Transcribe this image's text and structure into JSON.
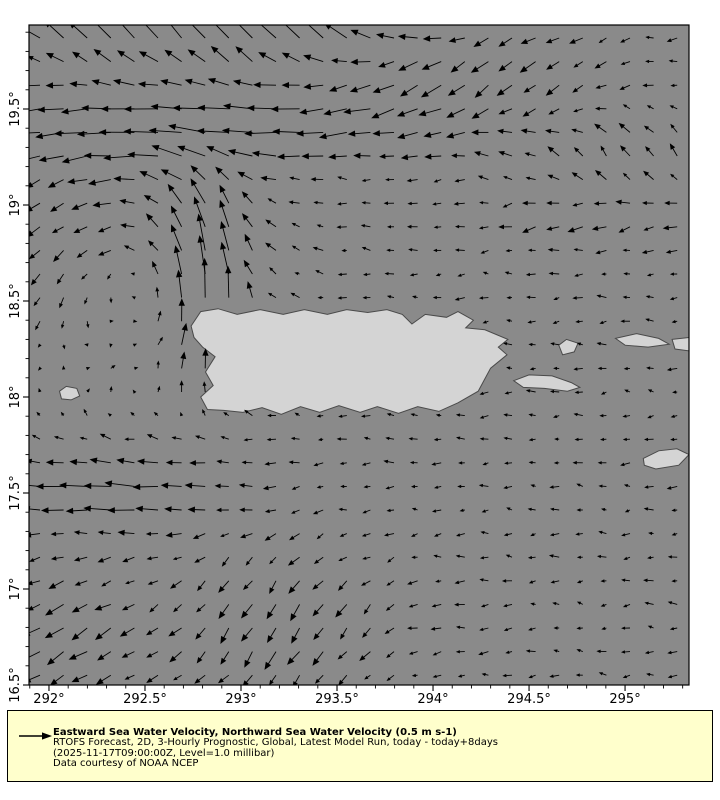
{
  "window": {
    "width": 720,
    "height": 800,
    "background": "#ffffff"
  },
  "map": {
    "plot_left": 29,
    "plot_top": 25,
    "plot_width": 660,
    "plot_height": 660,
    "lon_min": 291.896,
    "lon_max": 295.333,
    "lat_min": 16.5,
    "lat_max": 19.9375,
    "ocean_color": "#8a8a8a",
    "land_color": "#d4d4d4",
    "coast_color": "#4a4a4a",
    "arrow_color": "#000000",
    "frame_color": "#000000",
    "tick_label_color": "#000000"
  },
  "axes": {
    "font_size": 13,
    "minor_step": 0.1,
    "x_ticks": [
      {
        "lon": 292.0,
        "label": "292°"
      },
      {
        "lon": 292.5,
        "label": "292.5°"
      },
      {
        "lon": 293.0,
        "label": "293°"
      },
      {
        "lon": 293.5,
        "label": "293.5°"
      },
      {
        "lon": 294.0,
        "label": "294°"
      },
      {
        "lon": 294.5,
        "label": "294.5°"
      },
      {
        "lon": 295.0,
        "label": "295°"
      }
    ],
    "y_ticks": [
      {
        "lat": 16.5,
        "label": "16.5°"
      },
      {
        "lat": 17.0,
        "label": "17°"
      },
      {
        "lat": 17.5,
        "label": "17.5°"
      },
      {
        "lat": 18.0,
        "label": "18°"
      },
      {
        "lat": 18.5,
        "label": "18.5°"
      },
      {
        "lat": 19.0,
        "label": "19°"
      },
      {
        "lat": 19.5,
        "label": "19.5°"
      }
    ]
  },
  "islands": [
    {
      "name": "puerto-rico",
      "points": [
        [
          292.74,
          18.37
        ],
        [
          292.79,
          18.445
        ],
        [
          292.88,
          18.46
        ],
        [
          292.98,
          18.43
        ],
        [
          293.1,
          18.455
        ],
        [
          293.22,
          18.43
        ],
        [
          293.33,
          18.455
        ],
        [
          293.45,
          18.43
        ],
        [
          293.55,
          18.455
        ],
        [
          293.66,
          18.44
        ],
        [
          293.76,
          18.455
        ],
        [
          293.84,
          18.43
        ],
        [
          293.89,
          18.38
        ],
        [
          293.96,
          18.43
        ],
        [
          294.07,
          18.415
        ],
        [
          294.13,
          18.445
        ],
        [
          294.21,
          18.4
        ],
        [
          294.17,
          18.36
        ],
        [
          294.27,
          18.35
        ],
        [
          294.39,
          18.3
        ],
        [
          294.34,
          18.26
        ],
        [
          294.385,
          18.22
        ],
        [
          294.3,
          18.15
        ],
        [
          294.235,
          18.03
        ],
        [
          294.13,
          17.97
        ],
        [
          294.03,
          17.925
        ],
        [
          293.92,
          17.95
        ],
        [
          293.82,
          17.915
        ],
        [
          293.71,
          17.95
        ],
        [
          293.62,
          17.92
        ],
        [
          293.51,
          17.955
        ],
        [
          293.41,
          17.92
        ],
        [
          293.31,
          17.95
        ],
        [
          293.21,
          17.91
        ],
        [
          293.11,
          17.945
        ],
        [
          293.01,
          17.92
        ],
        [
          292.91,
          17.93
        ],
        [
          292.825,
          17.935
        ],
        [
          292.79,
          18.0
        ],
        [
          292.855,
          18.06
        ],
        [
          292.815,
          18.13
        ],
        [
          292.865,
          18.21
        ],
        [
          292.8,
          18.26
        ],
        [
          292.755,
          18.31
        ]
      ]
    },
    {
      "name": "mona-island",
      "points": [
        [
          292.055,
          18.03
        ],
        [
          292.09,
          18.055
        ],
        [
          292.145,
          18.045
        ],
        [
          292.16,
          18.005
        ],
        [
          292.115,
          17.985
        ],
        [
          292.065,
          17.99
        ]
      ]
    },
    {
      "name": "vieques-island",
      "points": [
        [
          294.42,
          18.085
        ],
        [
          294.5,
          18.115
        ],
        [
          294.62,
          18.11
        ],
        [
          294.72,
          18.075
        ],
        [
          294.765,
          18.05
        ],
        [
          294.7,
          18.03
        ],
        [
          294.58,
          18.045
        ],
        [
          294.47,
          18.05
        ]
      ]
    },
    {
      "name": "culebra-island",
      "points": [
        [
          294.655,
          18.27
        ],
        [
          294.695,
          18.3
        ],
        [
          294.755,
          18.28
        ],
        [
          294.735,
          18.235
        ],
        [
          294.675,
          18.22
        ]
      ]
    },
    {
      "name": "st-thomas-island",
      "points": [
        [
          294.95,
          18.305
        ],
        [
          295.06,
          18.33
        ],
        [
          295.175,
          18.305
        ],
        [
          295.23,
          18.275
        ],
        [
          295.12,
          18.26
        ],
        [
          295.0,
          18.27
        ]
      ]
    },
    {
      "name": "tortola-island",
      "points": [
        [
          295.245,
          18.3
        ],
        [
          295.333,
          18.31
        ],
        [
          295.333,
          18.24
        ],
        [
          295.26,
          18.25
        ]
      ]
    },
    {
      "name": "st-croix-island",
      "points": [
        [
          295.095,
          17.68
        ],
        [
          295.175,
          17.72
        ],
        [
          295.27,
          17.73
        ],
        [
          295.333,
          17.7
        ],
        [
          295.28,
          17.645
        ],
        [
          295.16,
          17.625
        ],
        [
          295.1,
          17.645
        ]
      ]
    }
  ],
  "chart_data": {
    "type": "quiver",
    "title": "Eastward Sea Water Velocity, Northward Sea Water Velocity (0.5 m s-1)",
    "xlabel": "",
    "ylabel": "",
    "x_range": [
      291.896,
      295.333
    ],
    "y_range": [
      16.5,
      19.9375
    ],
    "x_tick_labels": [
      "292°",
      "292.5°",
      "293°",
      "293.5°",
      "294°",
      "294.5°",
      "295°"
    ],
    "y_tick_labels": [
      "16.5°",
      "17°",
      "17.5°",
      "18°",
      "18.5°",
      "19°",
      "19.5°"
    ],
    "reference_speed_ms": 0.5,
    "scale_px_per_ms": 56,
    "grid": {
      "x0": 40,
      "y0": 38,
      "dx": 23.6,
      "dy": 23.6,
      "nx": 28,
      "ny": 28
    },
    "noise_amp": 0.05,
    "field_features_estimated": [
      {
        "type": "uniform",
        "u": -0.14,
        "v": 0
      },
      {
        "type": "gauss",
        "lon": 292.9,
        "lat": 19.95,
        "sx": 1.1,
        "sy": 0.22,
        "u": -0.35,
        "v": 0.6
      },
      {
        "type": "gauss",
        "lon": 292.9,
        "lat": 19.42,
        "sx": 1.3,
        "sy": 0.22,
        "u": -0.42,
        "v": -0.02
      },
      {
        "type": "gauss",
        "lon": 292.82,
        "lat": 18.6,
        "sx": 0.22,
        "sy": 0.55,
        "u": 0.06,
        "v": 0.52
      },
      {
        "type": "vortex",
        "lon": 292.42,
        "lat": 18.68,
        "radius": 0.6,
        "strength": 0.42
      },
      {
        "type": "gauss",
        "lon": 292.35,
        "lat": 17.52,
        "sx": 0.6,
        "sy": 0.22,
        "u": -0.4,
        "v": 0.02
      },
      {
        "type": "gauss",
        "lon": 293.2,
        "lat": 16.8,
        "sx": 0.55,
        "sy": 0.45,
        "u": -0.04,
        "v": -0.3
      },
      {
        "type": "gauss",
        "lon": 292.1,
        "lat": 16.75,
        "sx": 0.45,
        "sy": 0.35,
        "u": -0.18,
        "v": -0.2
      },
      {
        "type": "gauss",
        "lon": 294.2,
        "lat": 19.75,
        "sx": 0.7,
        "sy": 0.35,
        "u": -0.1,
        "v": -0.28
      },
      {
        "type": "gauss",
        "lon": 295.05,
        "lat": 19.25,
        "sx": 0.7,
        "sy": 0.25,
        "u": 0.02,
        "v": 0.22
      },
      {
        "type": "gauss",
        "lon": 294.9,
        "lat": 18.95,
        "sx": 0.7,
        "sy": 0.15,
        "u": -0.12,
        "v": -0.12
      },
      {
        "type": "gauss",
        "lon": 292.15,
        "lat": 18.0,
        "sx": 0.3,
        "sy": 0.25,
        "u": 0.03,
        "v": 0.16
      }
    ]
  },
  "legend": {
    "bg": "#ffffcc",
    "border_color": "#000000",
    "title": "Eastward Sea Water Velocity, Northward Sea Water Velocity (0.5 m s-1)",
    "line2": "RTOFS Forecast, 2D, 3-Hourly Prognostic, Global, Latest Model Run, today - today+8days",
    "line3": "(2025-11-17T09:00:00Z, Level=1.0 millibar)",
    "line4": "Data courtesy of NOAA NCEP"
  }
}
